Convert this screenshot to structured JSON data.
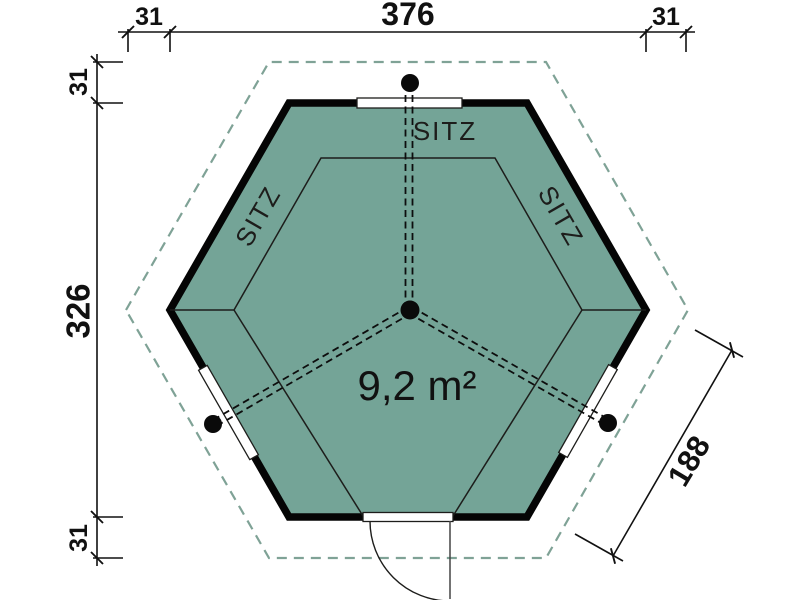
{
  "plan": {
    "type": "floor-plan",
    "subject": "hexagonal garden pavilion floor plan",
    "area_label": "9,2 m²",
    "seat_labels": [
      "SITZ",
      "SITZ",
      "SITZ"
    ],
    "dimensions": {
      "top_total": "376",
      "top_left_overhang": "31",
      "top_right_overhang": "31",
      "left_total": "326",
      "left_top_overhang": "31",
      "left_bottom_overhang": "31",
      "right_wall_length": "188"
    },
    "colors": {
      "floor_fill": "#74a497",
      "overhang_dash": "#7fa296",
      "wall_line": "#050505",
      "detail_line": "#1d1d1b",
      "dimension_line": "#111111",
      "area_text": "#ffffff",
      "background": "#ffffff"
    }
  }
}
